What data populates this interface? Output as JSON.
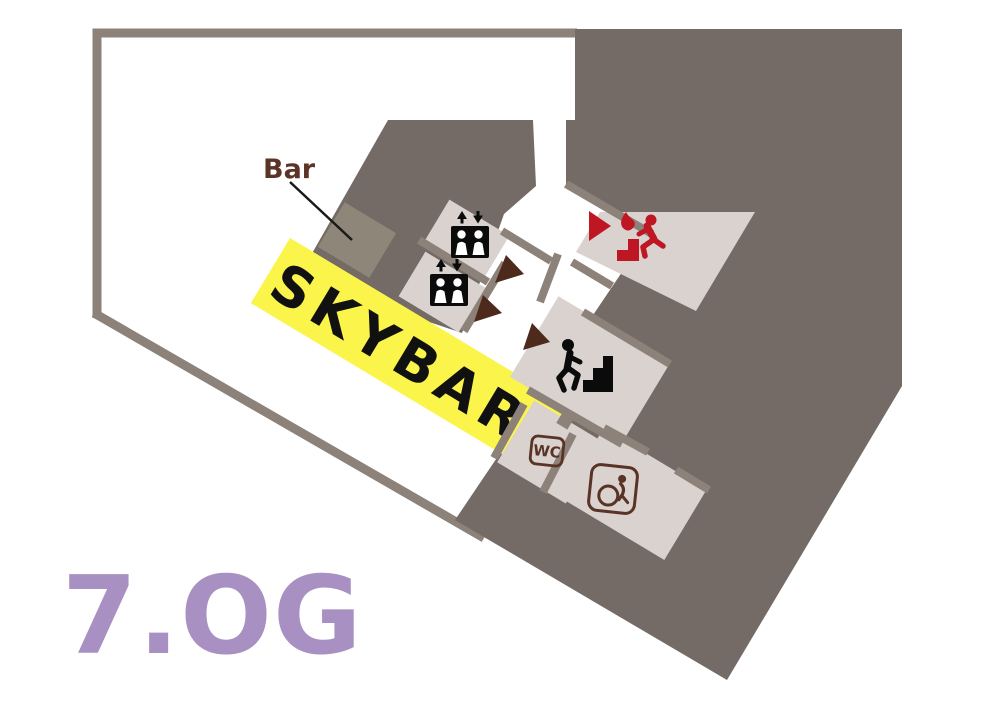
{
  "title": {
    "floor_label": "7.OG"
  },
  "annotations": {
    "bar_label": "Bar",
    "skybar_label": "SKYBAR",
    "wc_label": "WC"
  },
  "icons": {
    "elevator_upper": "elevator-icon",
    "elevator_lower": "elevator-icon",
    "stairs": "stairs-icon",
    "emergency_exit": "emergency-exit-icon",
    "wheelchair": "wheelchair-accessible-icon",
    "door_markers": [
      "door-marker-triangle",
      "door-marker-triangle",
      "door-marker-triangle"
    ],
    "exit_door_marker": "exit-door-marker-triangle"
  },
  "colors": {
    "background": "#ffffff",
    "walls": "#8C8279",
    "core_fill": "#746B66",
    "room_fill": "#D9D2CF",
    "skybar_band": "#FBF44B",
    "skybar_text": "#111111",
    "bar_counter": "#8E8678",
    "brown_text": "#5A3327",
    "bar_label_color": "#5C3327",
    "door_marker": "#4D2A1B",
    "emergency_red": "#BE1622",
    "floor_label_purple": "#A890C2"
  }
}
